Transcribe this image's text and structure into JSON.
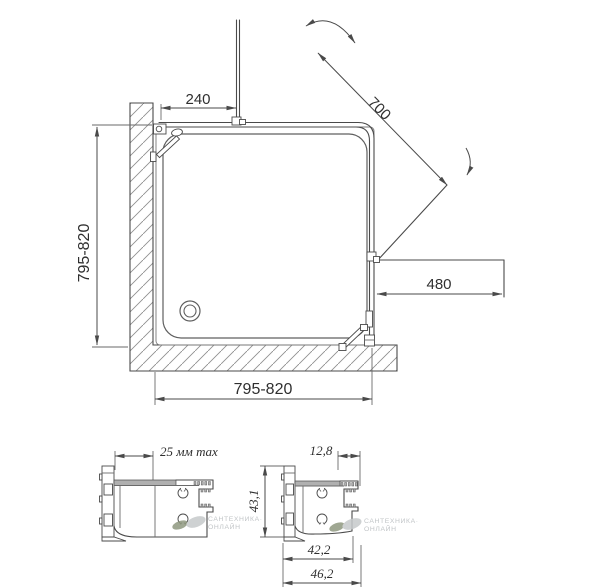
{
  "drawing": {
    "title": "shower-enclosure-technical-drawing",
    "main_view": {
      "dim_fixed_panel_width": "240",
      "dim_door_diagonal": "700",
      "dim_entry_width": "480",
      "dim_side_depth": "795-820",
      "dim_front_width": "795-820"
    },
    "detail_left": {
      "dim_adjustment": "25 мм max"
    },
    "detail_right": {
      "dim_top_lip": "12,8",
      "dim_height": "43,1",
      "dim_inner_width": "42,2",
      "dim_outer_width": "46,2"
    },
    "watermark": {
      "line1": "САНТЕХНИКА·",
      "line2": "ОНЛАЙН"
    },
    "icons": {
      "door-swing-arc": "curved double-headed arrow",
      "door-swing-arc-small": "small curved arrow",
      "drain": "concentric circles"
    },
    "colors": {
      "background": "#ffffff",
      "line": "#4a4a4a",
      "dim_text": "#2f2f2f",
      "hatch": "#8f8f8f",
      "profile_fill": "#b0b0b0",
      "watermark_text": "#b6babd",
      "leaf_dark": "#8f987f",
      "leaf_light": "#c6c9cb"
    }
  }
}
